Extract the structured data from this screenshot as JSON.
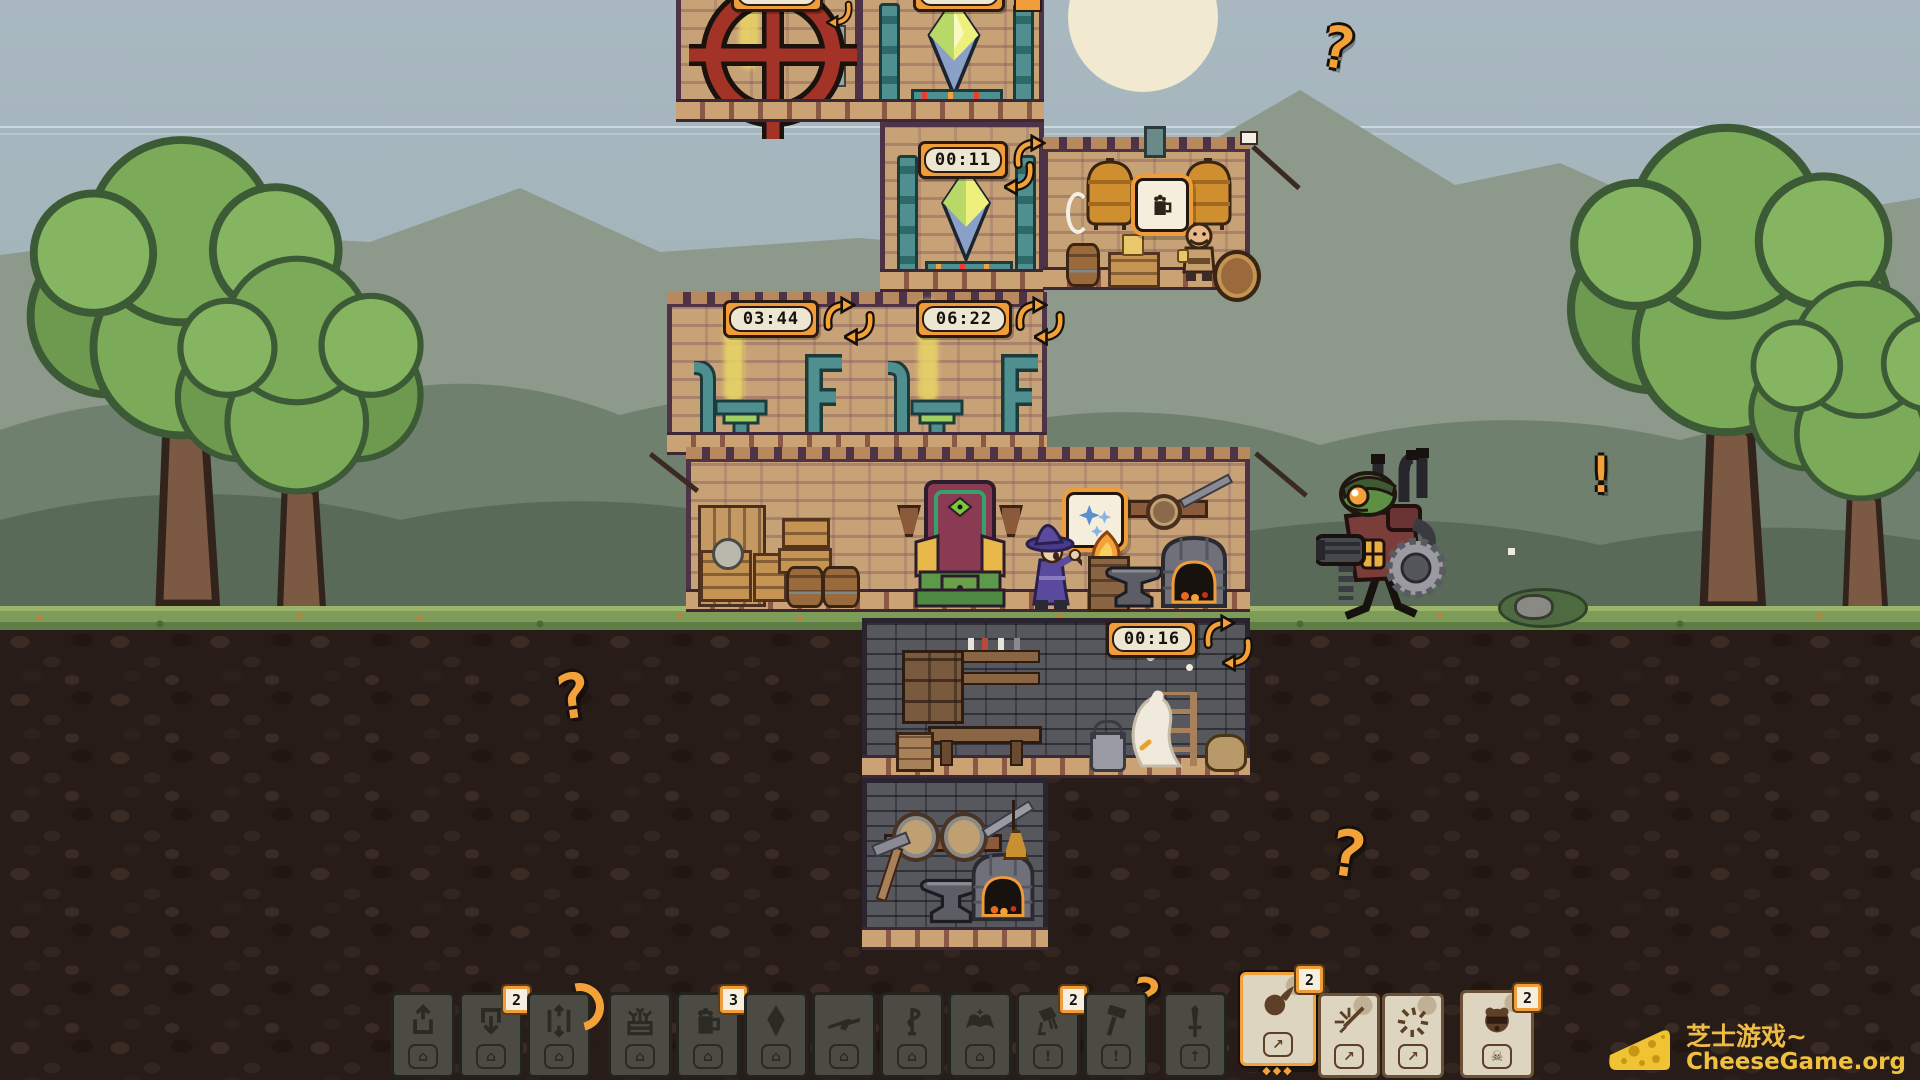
{
  "colors": {
    "accent_orange": "#f2a238",
    "timer_frame": "#ef9d3a",
    "timer_face": "#ece6d2",
    "card_dark": "#4b4b43",
    "card_light": "#ddd5c0",
    "sky": "#a9b8c0",
    "grass": "#7c9c58",
    "watermark_yellow": "#eebc45",
    "wheel_red": "#a43327",
    "pipe_teal": "#4f8f8f"
  },
  "timers": {
    "top_left": "00:26",
    "top_right": "00:14",
    "crystal": "00:11",
    "steam_left": "03:44",
    "steam_right": "06:22",
    "cellar": "00:16"
  },
  "markers": {
    "question_mark": "?",
    "alert_mark": "!"
  },
  "speech_bubbles": {
    "brewer_icon": "beer-mug-icon",
    "wizard_icon": "sparkles-icon"
  },
  "scene": {
    "rooms": [
      "alchemy-wheel-room",
      "crystal-room-upper",
      "brewery-room",
      "crystal-room",
      "steam-workshop-room",
      "throne-hall",
      "cellar-room",
      "forge-cellar-room"
    ],
    "characters": [
      "wizard",
      "brewer-dwarf",
      "white-goose",
      "goblin-mech"
    ]
  },
  "hotbar": {
    "cards": [
      {
        "name": "room-card-export",
        "icon": "arrow-up-out-icon",
        "badge": "",
        "footer": "house",
        "style": "dark"
      },
      {
        "name": "room-card-import",
        "icon": "arrow-down-in-icon",
        "badge": "2",
        "footer": "house",
        "style": "dark"
      },
      {
        "name": "room-card-elevator",
        "icon": "arrow-up-down-icon",
        "badge": "",
        "footer": "house",
        "style": "dark",
        "progress": true
      },
      {
        "name": "room-card-farm",
        "icon": "planter-icon",
        "badge": "",
        "footer": "house",
        "style": "dark"
      },
      {
        "name": "room-card-brewery",
        "icon": "beer-mug-icon",
        "badge": "3",
        "footer": "house",
        "style": "dark"
      },
      {
        "name": "room-card-crystal",
        "icon": "crystal-icon",
        "badge": "",
        "footer": "house",
        "style": "dark"
      },
      {
        "name": "room-card-gunsmith",
        "icon": "rifle-icon",
        "badge": "",
        "footer": "house",
        "style": "dark"
      },
      {
        "name": "room-card-alchemy",
        "icon": "snake-staff-icon",
        "badge": "",
        "footer": "house",
        "style": "dark"
      },
      {
        "name": "room-card-library",
        "icon": "spellbook-icon",
        "badge": "",
        "footer": "house",
        "style": "dark"
      },
      {
        "name": "action-card-pour",
        "icon": "pouring-bucket-icon",
        "badge": "2",
        "footer": "exclaim",
        "style": "dark"
      },
      {
        "name": "action-card-build",
        "icon": "hammer-icon",
        "badge": "",
        "footer": "exclaim",
        "style": "dark"
      },
      {
        "name": "unit-card-sword",
        "icon": "sword-icon",
        "badge": "",
        "footer": "arrow-up",
        "style": "dark"
      },
      {
        "name": "spell-card-fireball",
        "icon": "fireball-icon",
        "badge": "2",
        "footer": "cast",
        "style": "light",
        "selected": true
      },
      {
        "name": "spell-card-slash",
        "icon": "slash-icon",
        "badge": "",
        "footer": "cast",
        "style": "light"
      },
      {
        "name": "spell-card-burst",
        "icon": "burst-icon",
        "badge": "",
        "footer": "cast",
        "style": "light"
      },
      {
        "name": "spell-card-beast",
        "icon": "beast-head-icon",
        "badge": "2",
        "footer": "skull",
        "style": "light"
      }
    ]
  },
  "watermark": {
    "logo_icon": "cheese-icon",
    "brand": "芝士游戏~",
    "site": "CheeseGame.org"
  }
}
